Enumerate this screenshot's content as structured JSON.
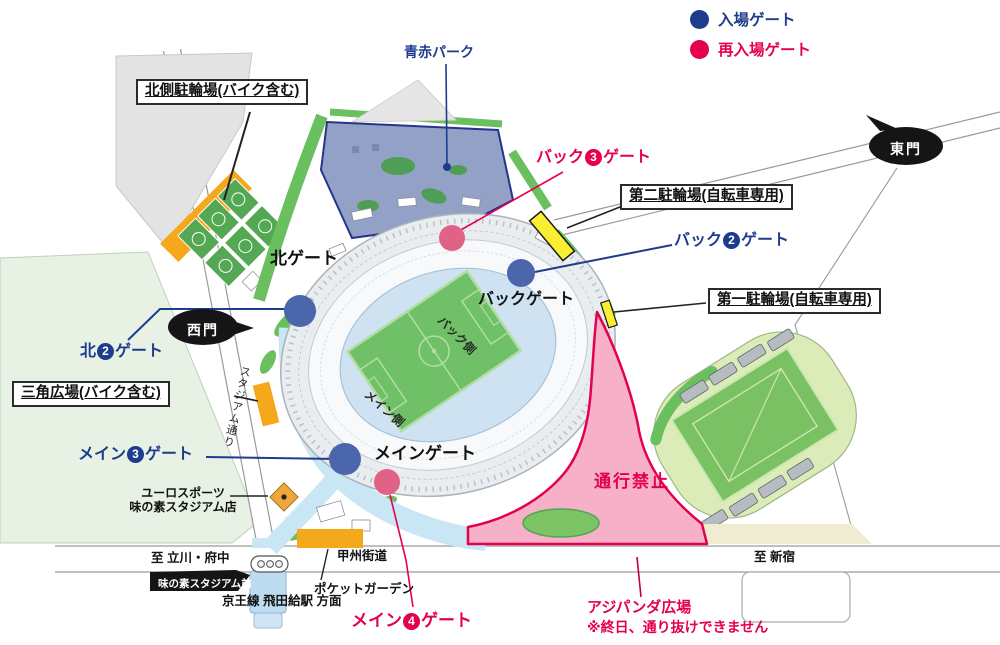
{
  "legend": {
    "entry_gate": "入場ゲート",
    "reentry_gate": "再入場ゲート"
  },
  "areas": {
    "aoaka_park": "青赤パーク",
    "no_passage": "通行禁止",
    "ajipanda_plaza": "アジパンダ広場",
    "ajipanda_note": "※終日、通り抜けできません",
    "pocket_garden": "ポケットガーデン",
    "euro_sports_line1": "ユーロスポーツ",
    "euro_sports_line2": "味の素スタジアム店"
  },
  "parking": {
    "north": "北側駐輪場(バイク含む)",
    "second": "第二駐輪場(自転車専用)",
    "first": "第一駐輪場(自転車専用)",
    "triangle": "三角広場(バイク含む)"
  },
  "gates": {
    "north_gate": "北ゲート",
    "back_gate": "バックゲート",
    "main_gate": "メインゲート",
    "east_gate": "東門",
    "west_gate": "西門",
    "back3": {
      "pre": "バック",
      "num": "3",
      "post": "ゲート"
    },
    "back2": {
      "pre": "バック",
      "num": "2",
      "post": "ゲート"
    },
    "north2": {
      "pre": "北",
      "num": "2",
      "post": "ゲート"
    },
    "main3": {
      "pre": "メイン",
      "num": "3",
      "post": "ゲート"
    },
    "main4": {
      "pre": "メイン",
      "num": "4",
      "post": "ゲート"
    }
  },
  "roads": {
    "stadium_street": "スタジアム通り",
    "koshu_kaido": "甲州街道",
    "to_tachikawa": "至 立川・府中",
    "to_shinjuku": "至 新宿",
    "keio_line": "京王線 飛田給駅 方面",
    "station_stop": "味の素スタジアム前"
  },
  "stadium": {
    "back_side": "バック側",
    "main_side": "メイン側"
  },
  "colors": {
    "entry_blue": "#1e3b8d",
    "reentry_red": "#e5004f",
    "gate_marker_blue": "#4c66ac",
    "reentry_marker_pink": "#e06287",
    "no_passage_pink": "#f6b0c8",
    "bicycle_yellow": "#f8ee33",
    "bike_orange": "#f5a81c",
    "park_blue": "#93a1c6",
    "greenery": "#6abf5e"
  }
}
